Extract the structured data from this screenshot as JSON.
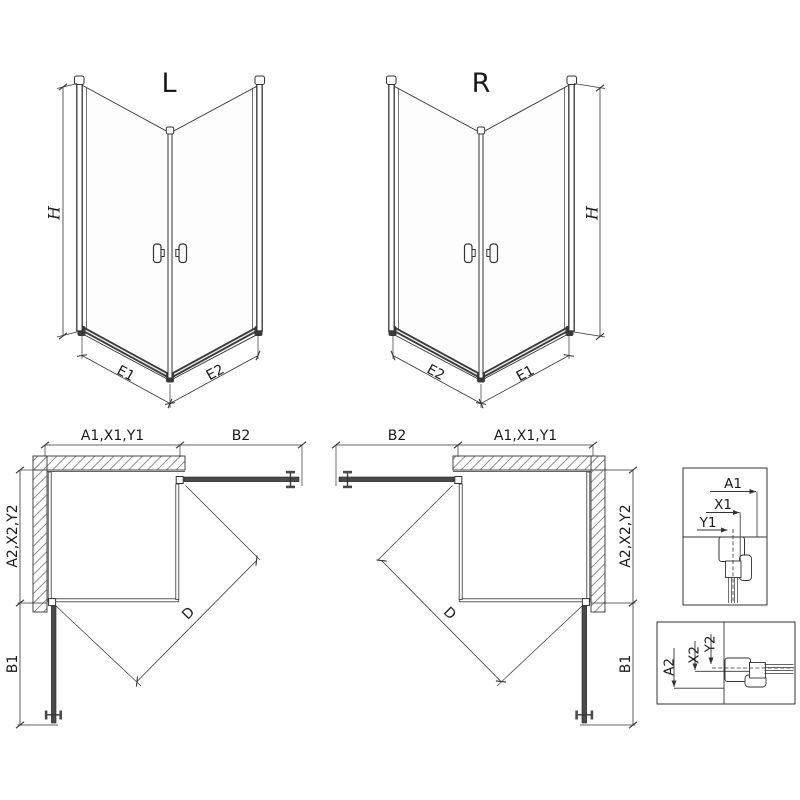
{
  "drawing": {
    "iso_left": {
      "label": "L",
      "height": "H",
      "edge_left": "E1",
      "edge_right": "E2"
    },
    "iso_right": {
      "label": "R",
      "height": "H",
      "edge_left": "E2",
      "edge_right": "E1"
    },
    "plan_left": {
      "top_main": "A1,X1,Y1",
      "top_door": "B2",
      "side_main": "A2,X2,Y2",
      "side_door": "B1",
      "diagonal": "D"
    },
    "plan_right": {
      "top_door": "B2",
      "top_main": "A1,X1,Y1",
      "side_main": "A2,X2,Y2",
      "side_door": "B1",
      "diagonal": "D"
    },
    "detail_top": {
      "dim1": "A1",
      "dim2": "X1",
      "dim3": "Y1"
    },
    "detail_bottom": {
      "dim1": "A2",
      "dim2": "X2",
      "dim3": "Y2"
    },
    "colors": {
      "line": "#333333",
      "profile": "#4a4a4a",
      "hatch": "#828282",
      "background": "#ffffff"
    }
  }
}
